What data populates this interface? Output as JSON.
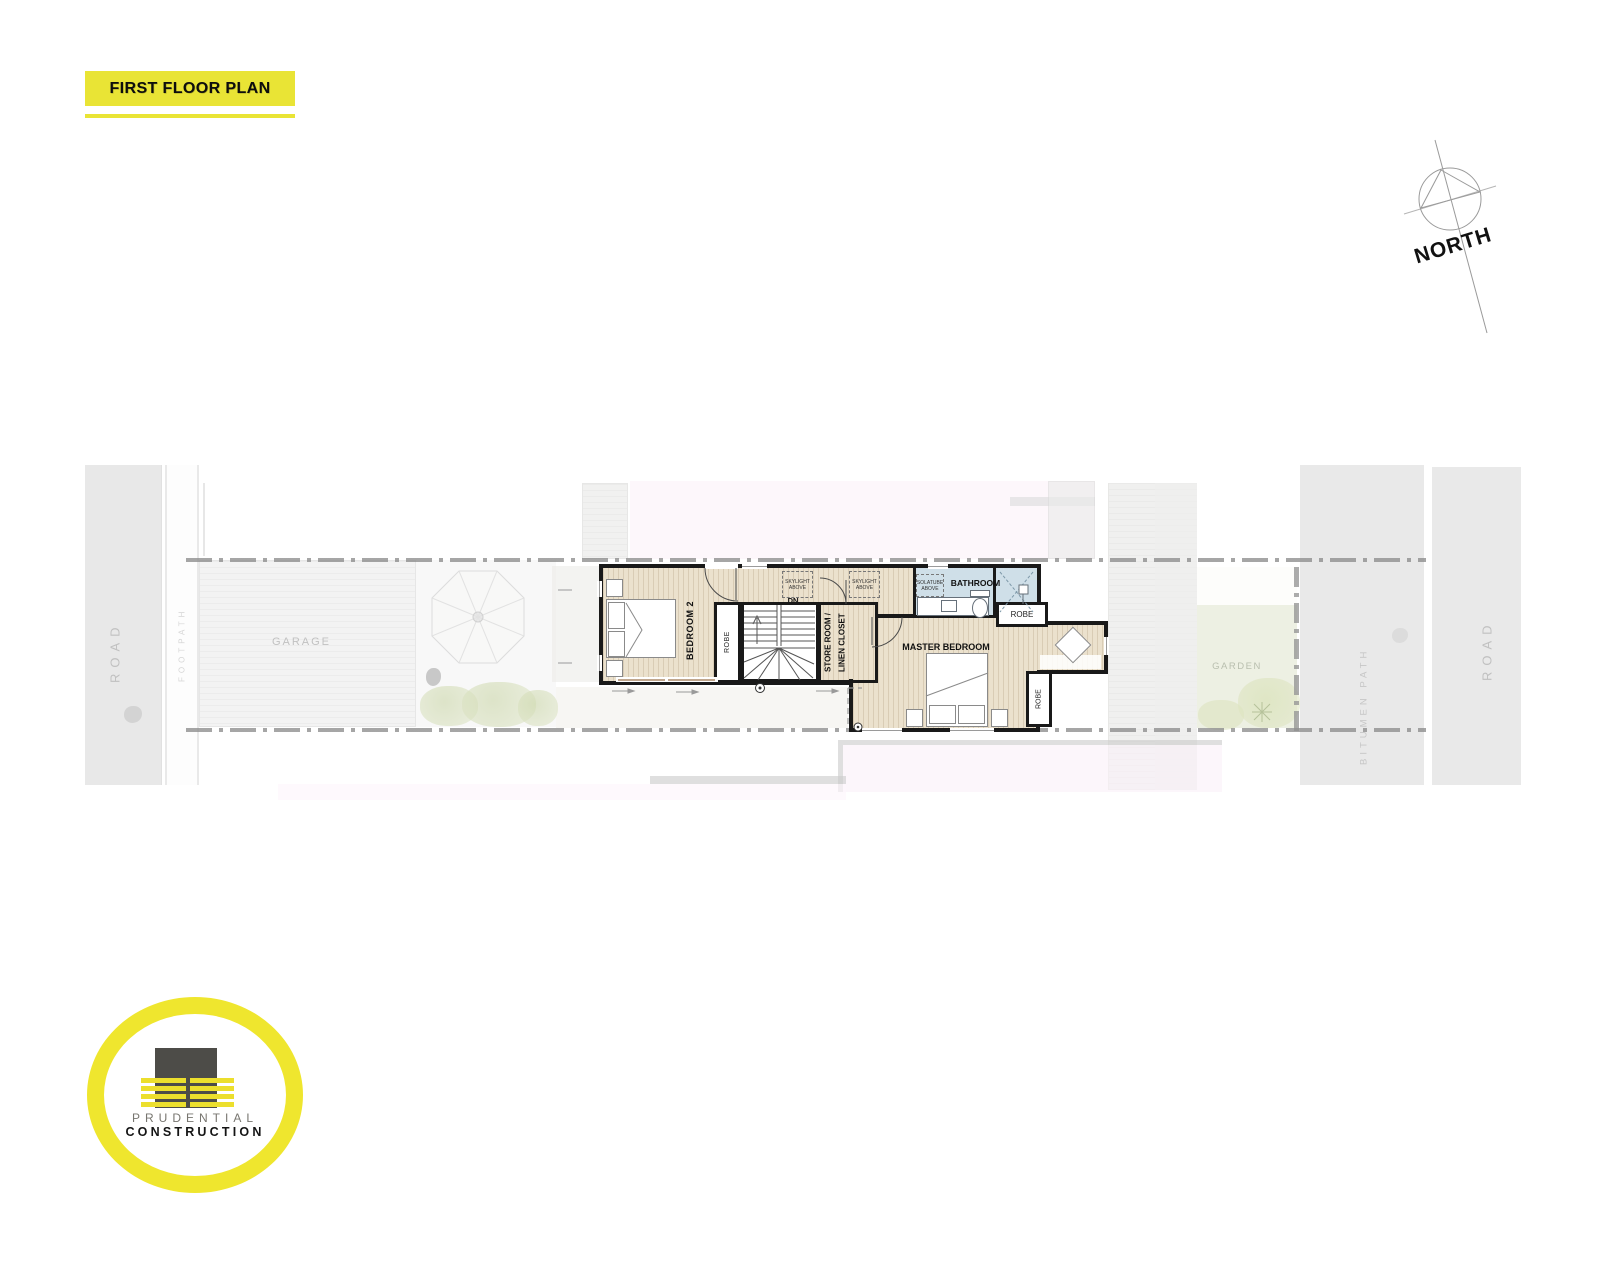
{
  "title": "FIRST FLOOR PLAN",
  "compass": {
    "label": "NORTH"
  },
  "site": {
    "road_left": "ROAD",
    "footpath": "FOOTPATH",
    "garage": "GARAGE",
    "garden": "GARDEN",
    "bitumen_path": "BITUMEN PATH",
    "road_right": "ROAD"
  },
  "rooms": {
    "bedroom2": "BEDROOM 2",
    "robe": "ROBE",
    "store_room_line1": "STORE ROOM /",
    "store_room_line2": "LINEN CLOSET",
    "master_bedroom": "MASTER BEDROOM",
    "bathroom": "BATHROOM",
    "stairs_dn": "DN",
    "skylight": "SKYLIGHT ABOVE",
    "solatube": "SOLATUBE ABOVE"
  },
  "logo": {
    "line1": "PRUDENTIAL",
    "line2": "CONSTRUCTION"
  },
  "colors": {
    "accent_yellow": "#e9e435",
    "wall_black": "#191919",
    "wood_floor": "#ebe1cd",
    "bathroom_blue": "#cfdfe8",
    "boundary_gray": "#8f8f8f",
    "road_gray": "#dbdbdb",
    "garden_green": "#e2e7d2",
    "neighbor_pink": "#fbf2f9"
  }
}
